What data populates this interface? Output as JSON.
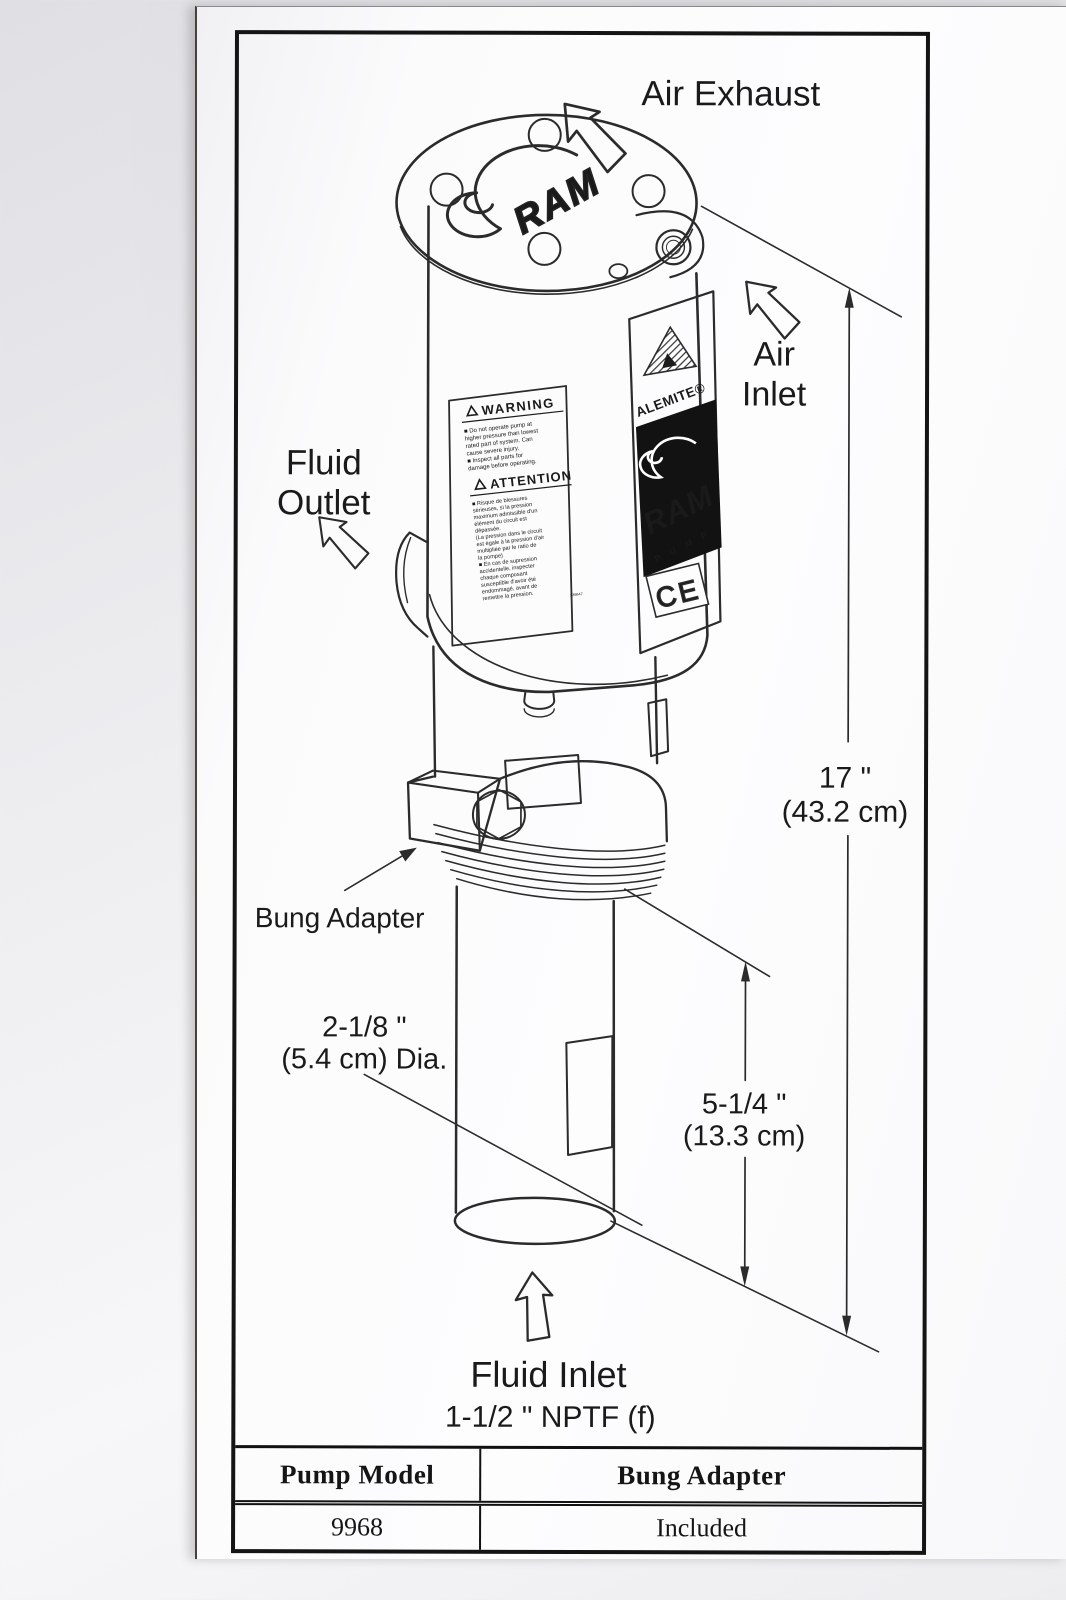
{
  "diagram": {
    "labels": {
      "air_exhaust": "Air Exhaust",
      "air_inlet_line1": "Air",
      "air_inlet_line2": "Inlet",
      "fluid_outlet_line1": "Fluid",
      "fluid_outlet_line2": "Outlet",
      "bung_adapter": "Bung Adapter",
      "fluid_inlet": "Fluid Inlet",
      "fluid_inlet_thread": "1-1/2 \" NPTF (f)"
    },
    "dimensions": {
      "height_in": "17 \"",
      "height_cm": "(43.2 cm)",
      "lower_tube_in": "5-1/4 \"",
      "lower_tube_cm": "(13.3  cm)",
      "tube_dia_in": "2-1/8 \"",
      "tube_dia_cm": "(5.4  cm) Dia."
    },
    "pump_markings": {
      "brand": "ALEMITE®",
      "ram_top": "RAM",
      "ram_panel": "RAM",
      "pump_letters": "P U M P",
      "ce_mark": "CE",
      "label_part_no": "339847"
    },
    "warning_label": {
      "en_title": "WARNING",
      "en_lines": [
        "■ Do not operate pump at",
        "higher pressure than lowest",
        "rated part of system. Can",
        "cause severe injury.",
        "■ Inspect all parts for",
        "damage before operating."
      ],
      "fr_title": "ATTENTION",
      "fr_lines": [
        "■ Risque de blessures",
        "sérieuses, si la pression",
        "maximum admissible d'un",
        "élément du circuit est",
        "dépassée.",
        "(La pression dans le circuit",
        "est égale à la pression d'air",
        "multipliée par le ratio de",
        "la pompe)",
        "■ En cas de supression",
        "accidentelle, inspecter",
        "chaque composant",
        "susceptible d'avoir été",
        "endommagé, avant de",
        "remettre la pression."
      ]
    }
  },
  "table": {
    "headers": [
      "Pump Model",
      "Bung Adapter"
    ],
    "rows": [
      [
        "9968",
        "Included"
      ]
    ]
  },
  "colors": {
    "ink": "#2b2b2b",
    "panel_black": "#121212",
    "paper": "#fbfbfc"
  }
}
